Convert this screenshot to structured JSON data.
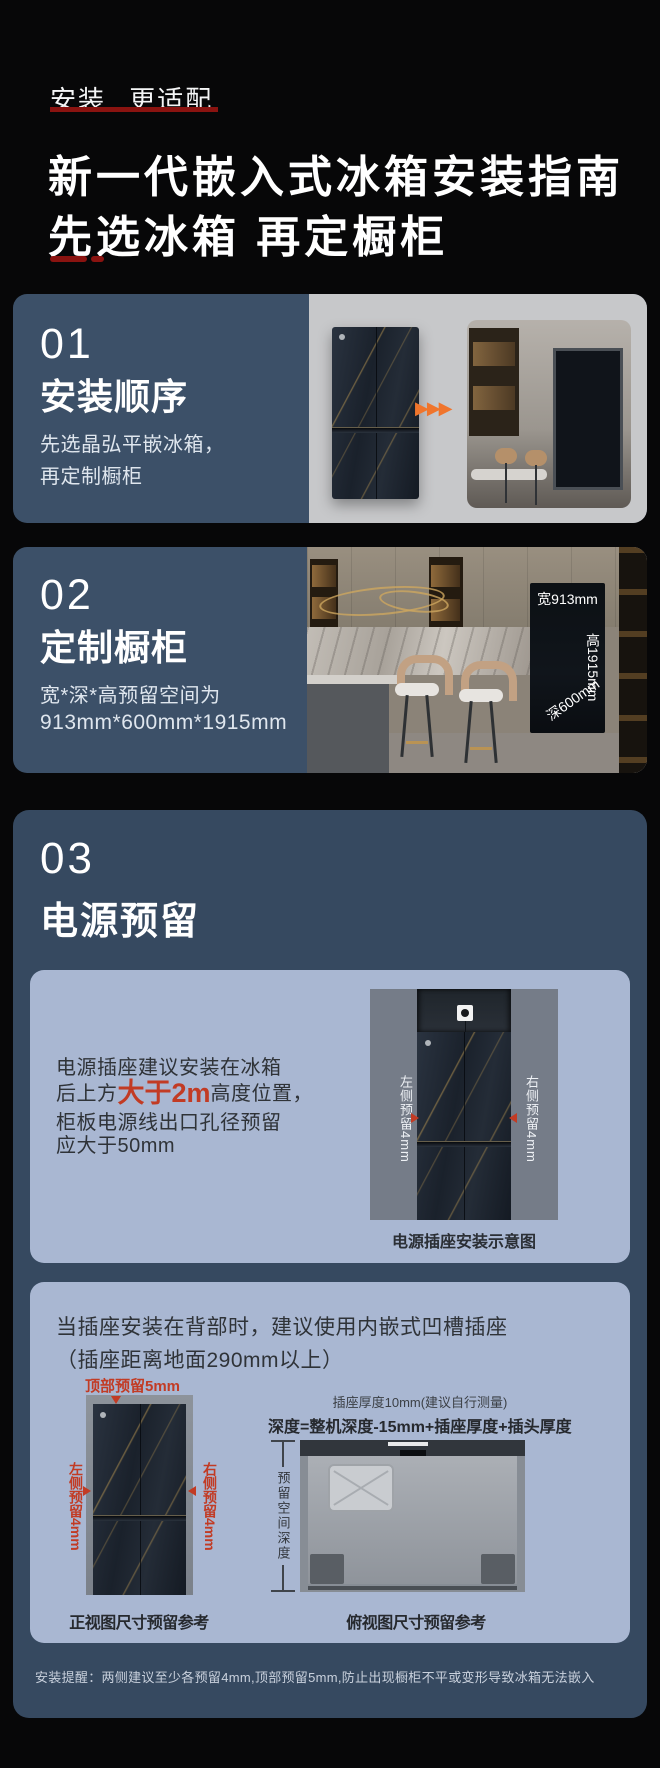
{
  "header": {
    "eyebrow": "安装 更适配",
    "title_line1": "新一代嵌入式冰箱安装指南",
    "title_line2": "先选冰箱 再定橱柜"
  },
  "icons": {
    "forward_arrows": "▶▶▶"
  },
  "section1": {
    "number": "01",
    "title": "安装顺序",
    "body_line1": "先选晶弘平嵌冰箱，",
    "body_line2": "再定制橱柜"
  },
  "section2": {
    "number": "02",
    "title": "定制橱柜",
    "body_line1": "宽*深*高预留空间为",
    "body_line2": "913mm*600mm*1915mm",
    "niche": {
      "width_label": "宽913mm",
      "height_label": "高1915mm",
      "depth_label": "深600mm"
    }
  },
  "section3": {
    "number": "03",
    "title": "电源预留",
    "socket_card": {
      "line1": "电源插座建议安装在冰箱",
      "line2_pre": "后上方",
      "line2_highlight": "大于2m",
      "line2_post": "高度位置，",
      "line3": "柜板电源线出口孔径预留",
      "line4": "应大于50mm",
      "left_label": "左侧预留4mm",
      "right_label": "右侧预留4mm",
      "caption": "电源插座安装示意图"
    },
    "recess_card": {
      "heading_line1": "当插座安装在背部时，建议使用内嵌式凹槽插座",
      "heading_line2": "（插座距离地面290mm以上）",
      "front_view": {
        "top_label": "顶部预留5mm",
        "left_label": "左侧预留4mm",
        "right_label": "右侧预留4mm",
        "caption": "正视图尺寸预留参考"
      },
      "top_view": {
        "socket_note": "插座厚度10mm(建议自行测量)",
        "formula": "深度=整机深度-15mm+插座厚度+插头厚度",
        "depth_label": "预留空间深度",
        "caption": "俯视图尺寸预留参考"
      }
    },
    "footnote": "安装提醒：两侧建议至少各预留4mm,顶部预留5mm,防止出现橱柜不平或变形导致冰箱无法嵌入"
  },
  "colors": {
    "background": "#070708",
    "card_blue": "#3c5068",
    "section3_blue": "#364960",
    "inner_card_blue": "#a9b7d2",
    "accent_red": "#8a1310",
    "highlight_red": "#c23b24",
    "arrow_orange": "#f0752c"
  }
}
